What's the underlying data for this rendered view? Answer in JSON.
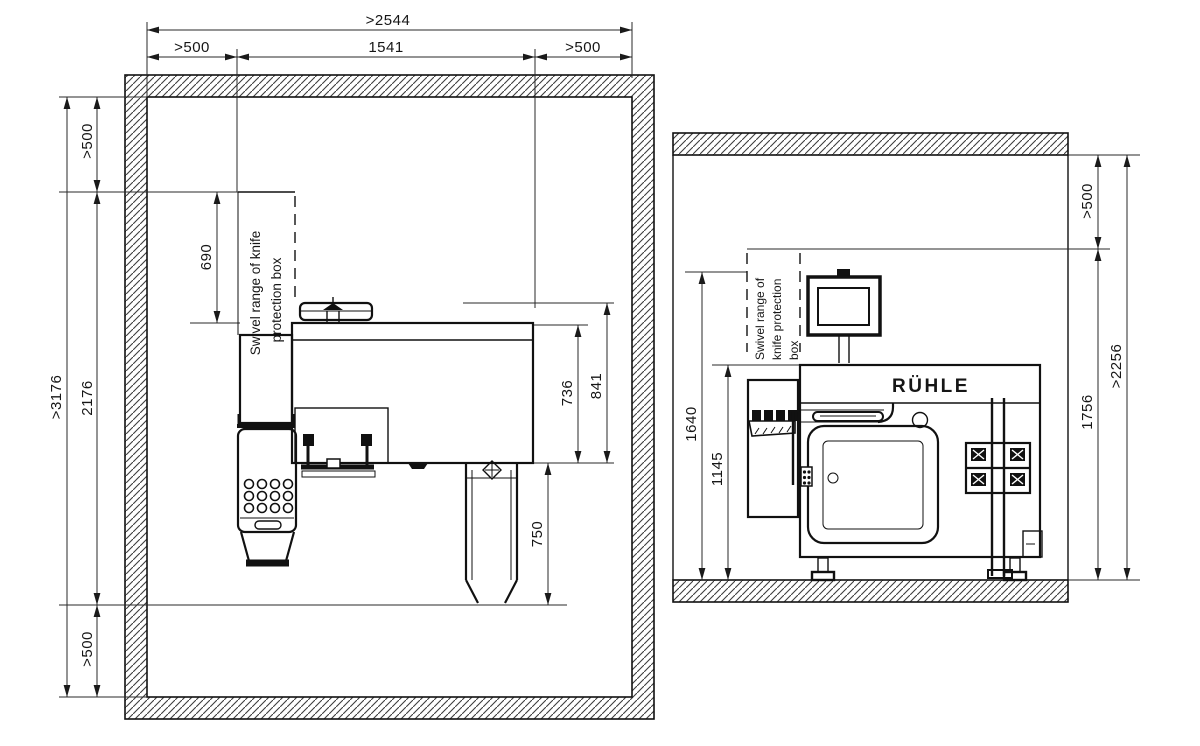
{
  "plan": {
    "dims": {
      "room_width": ">2544",
      "clear_left": ">500",
      "machine_width": "1541",
      "clear_right": ">500",
      "room_depth": ">3176",
      "machine_depth": "2176",
      "clear_top": ">500",
      "clear_bottom": ">500",
      "swivel_depth": "690",
      "body_736": "736",
      "body_841": "841",
      "discharge_750": "750"
    },
    "swivel_text": {
      "line1": "Swivel range of knife",
      "line2": "protection box"
    }
  },
  "elevation": {
    "dims": {
      "clear_ceiling": ">500",
      "machine_zone_height": "1756",
      "room_height": ">2256",
      "height_1640": "1640",
      "height_1145": "1145"
    },
    "swivel_text": {
      "line1": "Swivel range of",
      "line2": "knife protection",
      "line3": "box"
    },
    "brand": "RÜHLE"
  },
  "colors": {
    "ink": "#161616",
    "paper": "#ffffff"
  }
}
